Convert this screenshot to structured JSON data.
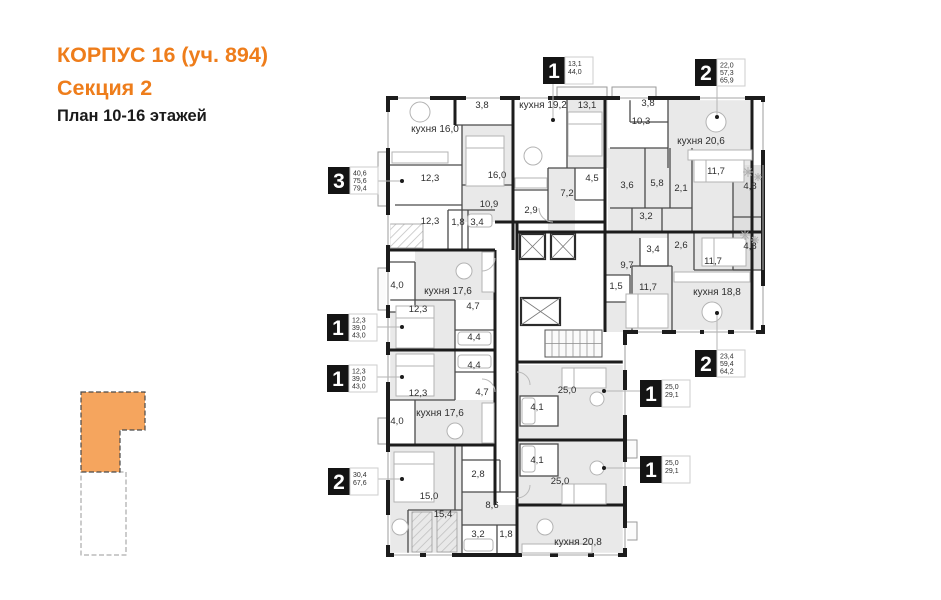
{
  "header": {
    "title_line1": "КОРПУС 16 (уч. 894)",
    "title_line2": "Секция 2",
    "subtitle": "План 10-16 этажей"
  },
  "colors": {
    "accent_orange": "#ee7d1b",
    "minimap_section_fill": "#f5a55e",
    "wall": "#1c1c1c",
    "room_shade": "#e9e9e9",
    "loggia_shade": "#dfdfdf"
  },
  "plan": {
    "room_labels": [
      {
        "t": "кухня 16,0",
        "x": 435,
        "y": 132,
        "k": 1
      },
      {
        "t": "3,8",
        "x": 482,
        "y": 108
      },
      {
        "t": "16,0",
        "x": 497,
        "y": 178
      },
      {
        "t": "12,3",
        "x": 430,
        "y": 181
      },
      {
        "t": "10,9",
        "x": 489,
        "y": 207
      },
      {
        "t": "12,3",
        "x": 430,
        "y": 224
      },
      {
        "t": "1,8",
        "x": 458,
        "y": 225
      },
      {
        "t": "3,4",
        "x": 477,
        "y": 225
      },
      {
        "t": "кухня 19,2",
        "x": 543,
        "y": 108,
        "k": 1
      },
      {
        "t": "13,1",
        "x": 587,
        "y": 108
      },
      {
        "t": "4,5",
        "x": 592,
        "y": 181
      },
      {
        "t": "7,2",
        "x": 567,
        "y": 196
      },
      {
        "t": "2,9",
        "x": 531,
        "y": 213
      },
      {
        "t": "3,8",
        "x": 648,
        "y": 106
      },
      {
        "t": "10,3",
        "x": 641,
        "y": 124
      },
      {
        "t": "кухня 20,6",
        "x": 701,
        "y": 144,
        "k": 1
      },
      {
        "t": "11,7",
        "x": 716,
        "y": 174
      },
      {
        "t": "4,8",
        "x": 750,
        "y": 189
      },
      {
        "t": "3,6",
        "x": 627,
        "y": 188
      },
      {
        "t": "5,8",
        "x": 657,
        "y": 186
      },
      {
        "t": "2,1",
        "x": 681,
        "y": 191
      },
      {
        "t": "3,2",
        "x": 646,
        "y": 219
      },
      {
        "t": "3,4",
        "x": 653,
        "y": 252
      },
      {
        "t": "2,6",
        "x": 681,
        "y": 248
      },
      {
        "t": "11,7",
        "x": 713,
        "y": 264
      },
      {
        "t": "4,8",
        "x": 750,
        "y": 249
      },
      {
        "t": "9,7",
        "x": 627,
        "y": 268
      },
      {
        "t": "1,5",
        "x": 616,
        "y": 289
      },
      {
        "t": "11,7",
        "x": 648,
        "y": 290
      },
      {
        "t": "кухня 18,8",
        "x": 717,
        "y": 295,
        "k": 1
      },
      {
        "t": "4,0",
        "x": 397,
        "y": 288
      },
      {
        "t": "кухня 17,6",
        "x": 448,
        "y": 294,
        "k": 1
      },
      {
        "t": "12,3",
        "x": 418,
        "y": 312
      },
      {
        "t": "4,7",
        "x": 473,
        "y": 309
      },
      {
        "t": "4,4",
        "x": 474,
        "y": 340
      },
      {
        "t": "4,4",
        "x": 474,
        "y": 368
      },
      {
        "t": "4,7",
        "x": 482,
        "y": 395
      },
      {
        "t": "12,3",
        "x": 418,
        "y": 396
      },
      {
        "t": "кухня 17,6",
        "x": 440,
        "y": 416,
        "k": 1
      },
      {
        "t": "4,0",
        "x": 397,
        "y": 424
      },
      {
        "t": "15,0",
        "x": 429,
        "y": 499
      },
      {
        "t": "2,8",
        "x": 478,
        "y": 477
      },
      {
        "t": "8,6",
        "x": 492,
        "y": 508
      },
      {
        "t": "15,4",
        "x": 443,
        "y": 517
      },
      {
        "t": "3,2",
        "x": 478,
        "y": 537
      },
      {
        "t": "1,8",
        "x": 506,
        "y": 537
      },
      {
        "t": "кухня 20,8",
        "x": 578,
        "y": 545,
        "k": 1
      },
      {
        "t": "25,0",
        "x": 567,
        "y": 393
      },
      {
        "t": "4,1",
        "x": 537,
        "y": 410
      },
      {
        "t": "4,1",
        "x": 537,
        "y": 463
      },
      {
        "t": "25,0",
        "x": 560,
        "y": 484
      }
    ],
    "badges": [
      {
        "d": "3",
        "areas": [
          "40,6",
          "75,6",
          "79,4"
        ],
        "x": 328,
        "y": 167,
        "lx": 402,
        "ly": 181,
        "side": "right"
      },
      {
        "d": "1",
        "areas": [
          "13,1",
          "44,0"
        ],
        "x": 543,
        "y": 57,
        "lx": 553,
        "ly": 120,
        "side": "down"
      },
      {
        "d": "2",
        "areas": [
          "22,0",
          "57,3",
          "65,9"
        ],
        "x": 695,
        "y": 59,
        "lx": 717,
        "ly": 117,
        "side": "down"
      },
      {
        "d": "1",
        "areas": [
          "12,3",
          "39,0",
          "43,0"
        ],
        "x": 327,
        "y": 314,
        "lx": 402,
        "ly": 327,
        "side": "right"
      },
      {
        "d": "1",
        "areas": [
          "12,3",
          "39,0",
          "43,0"
        ],
        "x": 327,
        "y": 365,
        "lx": 402,
        "ly": 377,
        "side": "right"
      },
      {
        "d": "2",
        "areas": [
          "30,4",
          "67,6"
        ],
        "x": 328,
        "y": 468,
        "lx": 402,
        "ly": 479,
        "side": "right"
      },
      {
        "d": "2",
        "areas": [
          "23,4",
          "59,4",
          "64,2"
        ],
        "x": 695,
        "y": 350,
        "lx": 717,
        "ly": 313,
        "side": "up"
      },
      {
        "d": "1",
        "areas": [
          "25,0",
          "29,1"
        ],
        "x": 640,
        "y": 380,
        "lx": 604,
        "ly": 391,
        "side": "left"
      },
      {
        "d": "1",
        "areas": [
          "25,0",
          "29,1"
        ],
        "x": 640,
        "y": 456,
        "lx": 604,
        "ly": 468,
        "side": "left"
      }
    ]
  }
}
